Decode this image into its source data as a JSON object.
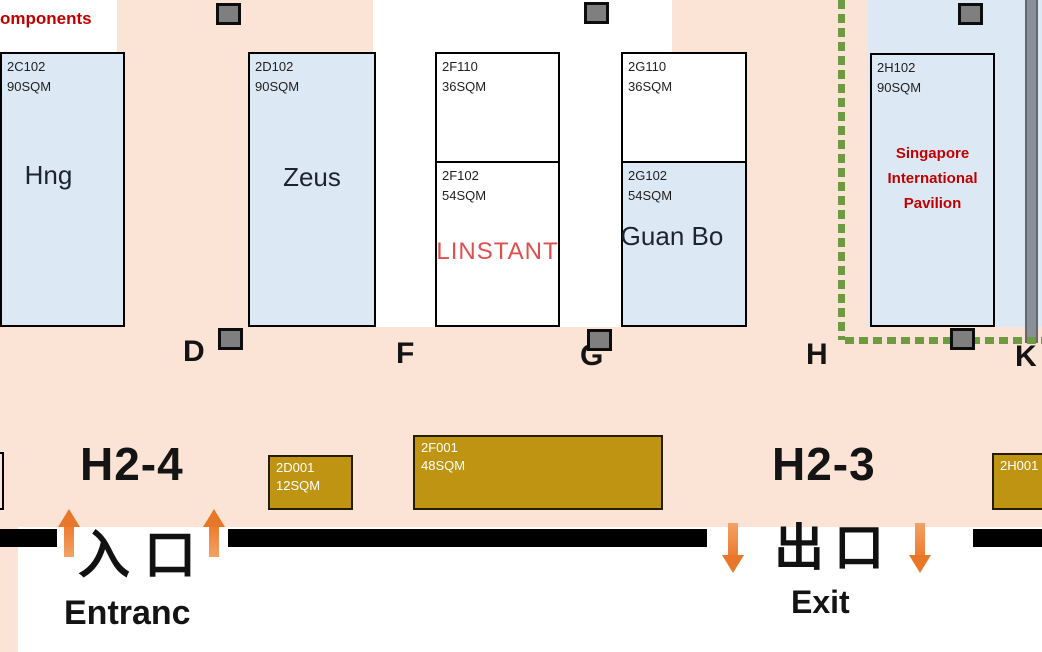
{
  "legend_fragment": "omponents",
  "booths": [
    {
      "id": "2C102",
      "size": "90SQM",
      "name": "Hng"
    },
    {
      "id": "2D102",
      "size": "90SQM",
      "name": "Zeus"
    },
    {
      "id": "2F110",
      "size": "36SQM"
    },
    {
      "id": "2F102",
      "size": "54SQM",
      "name": "LINSTANT"
    },
    {
      "id": "2G110",
      "size": "36SQM"
    },
    {
      "id": "2G102",
      "size": "54SQM",
      "name": "Guan Bo"
    },
    {
      "id": "2H102",
      "size": "90SQM",
      "name_lines": [
        "Singapore",
        "International",
        "Pavilion"
      ]
    }
  ],
  "stands": [
    {
      "id": "2D001",
      "size": "12SQM"
    },
    {
      "id": "2F001",
      "size": "48SQM"
    },
    {
      "id": "2H001"
    }
  ],
  "aisle_letters": [
    "D",
    "F",
    "G",
    "H",
    "K"
  ],
  "entrance": {
    "hall": "H2-4",
    "label_cn": "入口",
    "label_en": "Entranc"
  },
  "exit": {
    "hall": "H2-3",
    "label_cn": "出口",
    "label_en": "Exit"
  },
  "colors": {
    "floor_peach": "#FBE3D6",
    "booth_blue": "#DCE9F5",
    "stand_gold": "#C09413",
    "accent_red": "#C00000",
    "linstant_red": "#E04E4E",
    "pavilion_dash_green": "#6E9B41",
    "arrow_orange": "#ED7D31",
    "pillar_gray": "#7F7F7F",
    "wall_black": "#000000"
  }
}
